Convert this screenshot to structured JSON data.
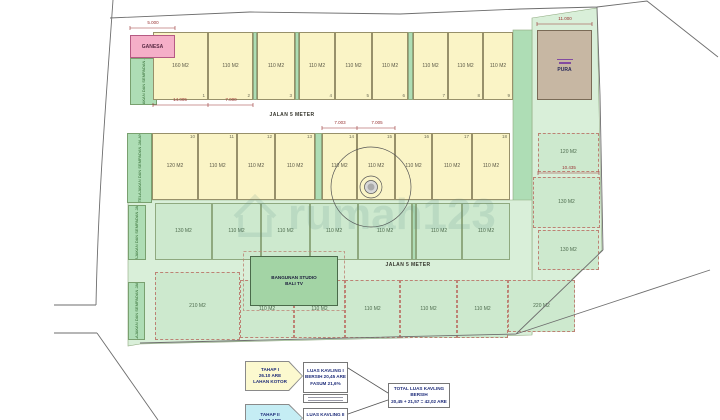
{
  "watermark": {
    "text": "rumah123"
  },
  "roads": {
    "label_top": "JALAN 5 METER",
    "label_lower": "JALAN 5 METER"
  },
  "strips": {
    "label": "TELAJAKAN DAN SEMPADAN JALAN"
  },
  "special": {
    "ganesa": "GANESA",
    "pura": "PURA",
    "studio_line1": "BANGUNAN STUDIO",
    "studio_line2": "BALI TV"
  },
  "plots": {
    "rowA": [
      {
        "num": "1",
        "area": "160 M2"
      },
      {
        "num": "2",
        "area": "110 M2"
      },
      {
        "num": "3",
        "area": "110 M2"
      },
      {
        "num": "4",
        "area": "110 M2"
      },
      {
        "num": "5",
        "area": "110 M2"
      },
      {
        "num": "6",
        "area": "110 M2"
      },
      {
        "num": "7",
        "area": "110 M2"
      },
      {
        "num": "8",
        "area": "110 M2"
      },
      {
        "num": "9",
        "area": "110 M2"
      }
    ],
    "rowB": [
      {
        "num": "10",
        "area": "120 M2"
      },
      {
        "num": "11",
        "area": "110 M2"
      },
      {
        "num": "12",
        "area": "110 M2"
      },
      {
        "num": "13",
        "area": "110 M2"
      },
      {
        "num": "14",
        "area": "110 M2"
      },
      {
        "num": "15",
        "area": "110 M2"
      },
      {
        "num": "16",
        "area": "110 M2"
      },
      {
        "num": "17",
        "area": "110 M2"
      },
      {
        "num": "18",
        "area": "110 M2"
      }
    ],
    "rowC": [
      {
        "area": "130 M2"
      },
      {
        "area": "110 M2"
      },
      {
        "area": "110 M2"
      },
      {
        "area": "110 M2"
      },
      {
        "area": "110 M2"
      },
      {
        "area": "110 M2"
      },
      {
        "area": "110 M2"
      }
    ],
    "rowD": [
      {
        "area": "210 M2"
      },
      {
        "area": "110 M2"
      },
      {
        "area": "110 M2"
      },
      {
        "area": "110 M2"
      },
      {
        "area": "110 M2"
      },
      {
        "area": "110 M2"
      },
      {
        "area": "220 M2"
      }
    ],
    "colR": [
      {
        "area": "120 M2"
      },
      {
        "area": "130 M2"
      },
      {
        "area": "130 M2"
      }
    ]
  },
  "dimensions": [
    "5.000",
    "14.005",
    "7.000",
    "7.003",
    "7.005",
    "11.000",
    "10.435"
  ],
  "legend": {
    "tahap1": {
      "line1": "TAHAP I",
      "line2": "26.10 ARE",
      "line3": "LAHAN KOTOR"
    },
    "kavling1": {
      "line1": "LUAS KAVLING I",
      "line2": "BERSIH 20,45 ARE",
      "line3": "FASUM 21,6%"
    },
    "tahap2": {
      "line1": "TAHAP II",
      "line2": "21,60 ARE"
    },
    "kavling2": {
      "line1": "LUAS KAVLING II"
    },
    "total": {
      "line1": "TOTAL LUAS KAVLING",
      "line2": "BERSIH",
      "line3": "20,45 + 21,57 = 42,02 ARE"
    }
  },
  "colors": {
    "plot_yellow": "#FAF4C6",
    "plot_green": "#CDE9CE",
    "bg_green": "#D9EFD9",
    "strip_green": "#AEDDB5",
    "ganesa_pink": "#F5AFC8",
    "pura_brown": "#C7B7A3",
    "studio_green": "#A3D4A5",
    "legend_yellow": "#FCF9CF",
    "legend_cyan": "#C5EDF4",
    "navy": "#1F2D7A",
    "dim_red": "#993333"
  }
}
